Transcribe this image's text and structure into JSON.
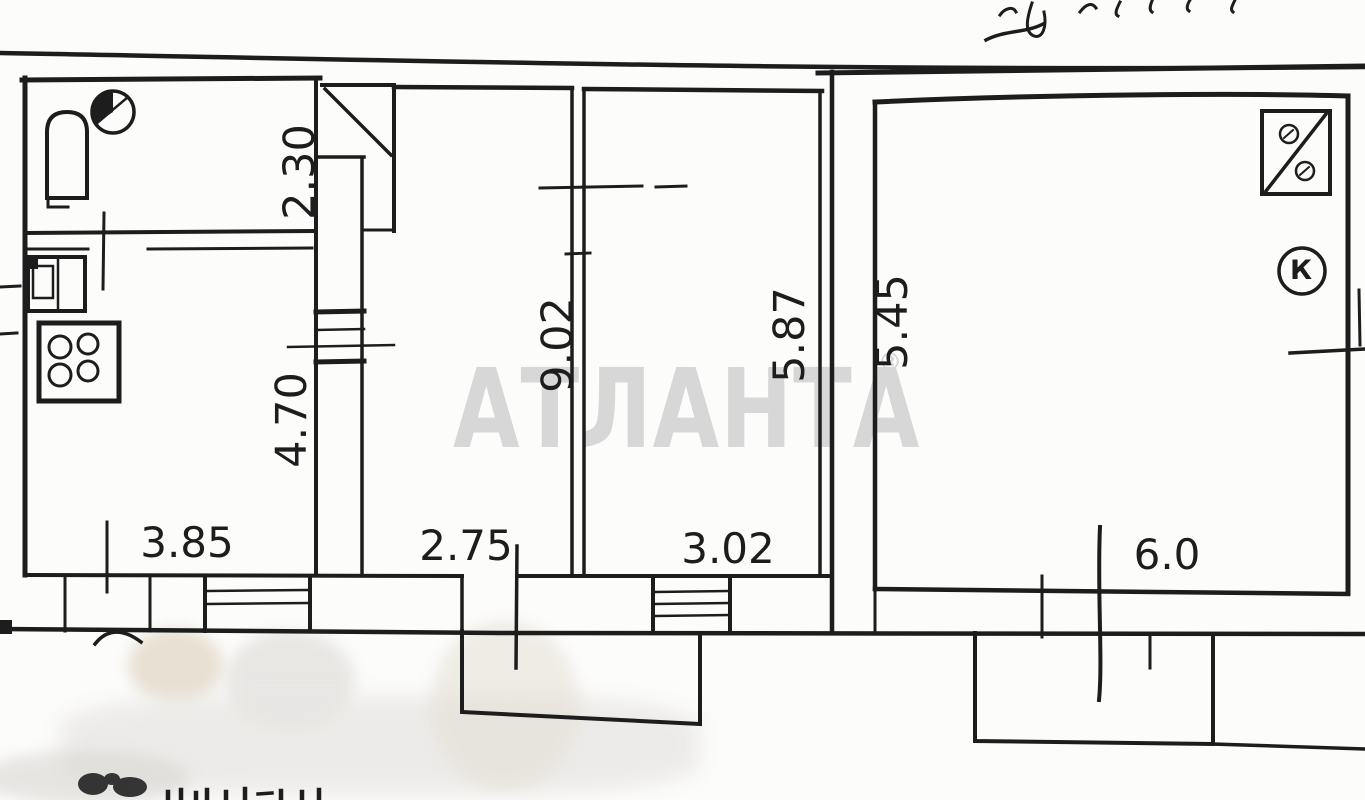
{
  "scan": {
    "background_color": "#fcfcfb",
    "ink_color": "#1d1d1d",
    "artifacts": {
      "top_right_note": "illegible cursive handwriting, cut off at page edge",
      "bottom_edge_text": "illegible text cut off at bottom edge"
    }
  },
  "watermark": {
    "text": "АТЛАНТА",
    "registered": "®",
    "color": "#d7d7d7"
  },
  "plan": {
    "dimensions": {
      "bathroom_depth": "2.30",
      "kitchen_depth": "4.70",
      "left_section_width": "3.85",
      "middle_room_width": "2.75",
      "middle_room_depth": "9.02",
      "right_middle_room_width": "3.02",
      "right_middle_room_depth": "5.87",
      "big_room_depth": "5.45",
      "big_room_width": "6.0"
    },
    "fixtures": {
      "boiler_letter": "К",
      "symbols": [
        "toilet-symbol",
        "washbasin-symbol",
        "kitchen-sink-symbol",
        "stove-4-burner-symbol",
        "corner-unit-symbol",
        "boiler-symbol",
        "ventilation-shaft-symbol"
      ]
    }
  }
}
